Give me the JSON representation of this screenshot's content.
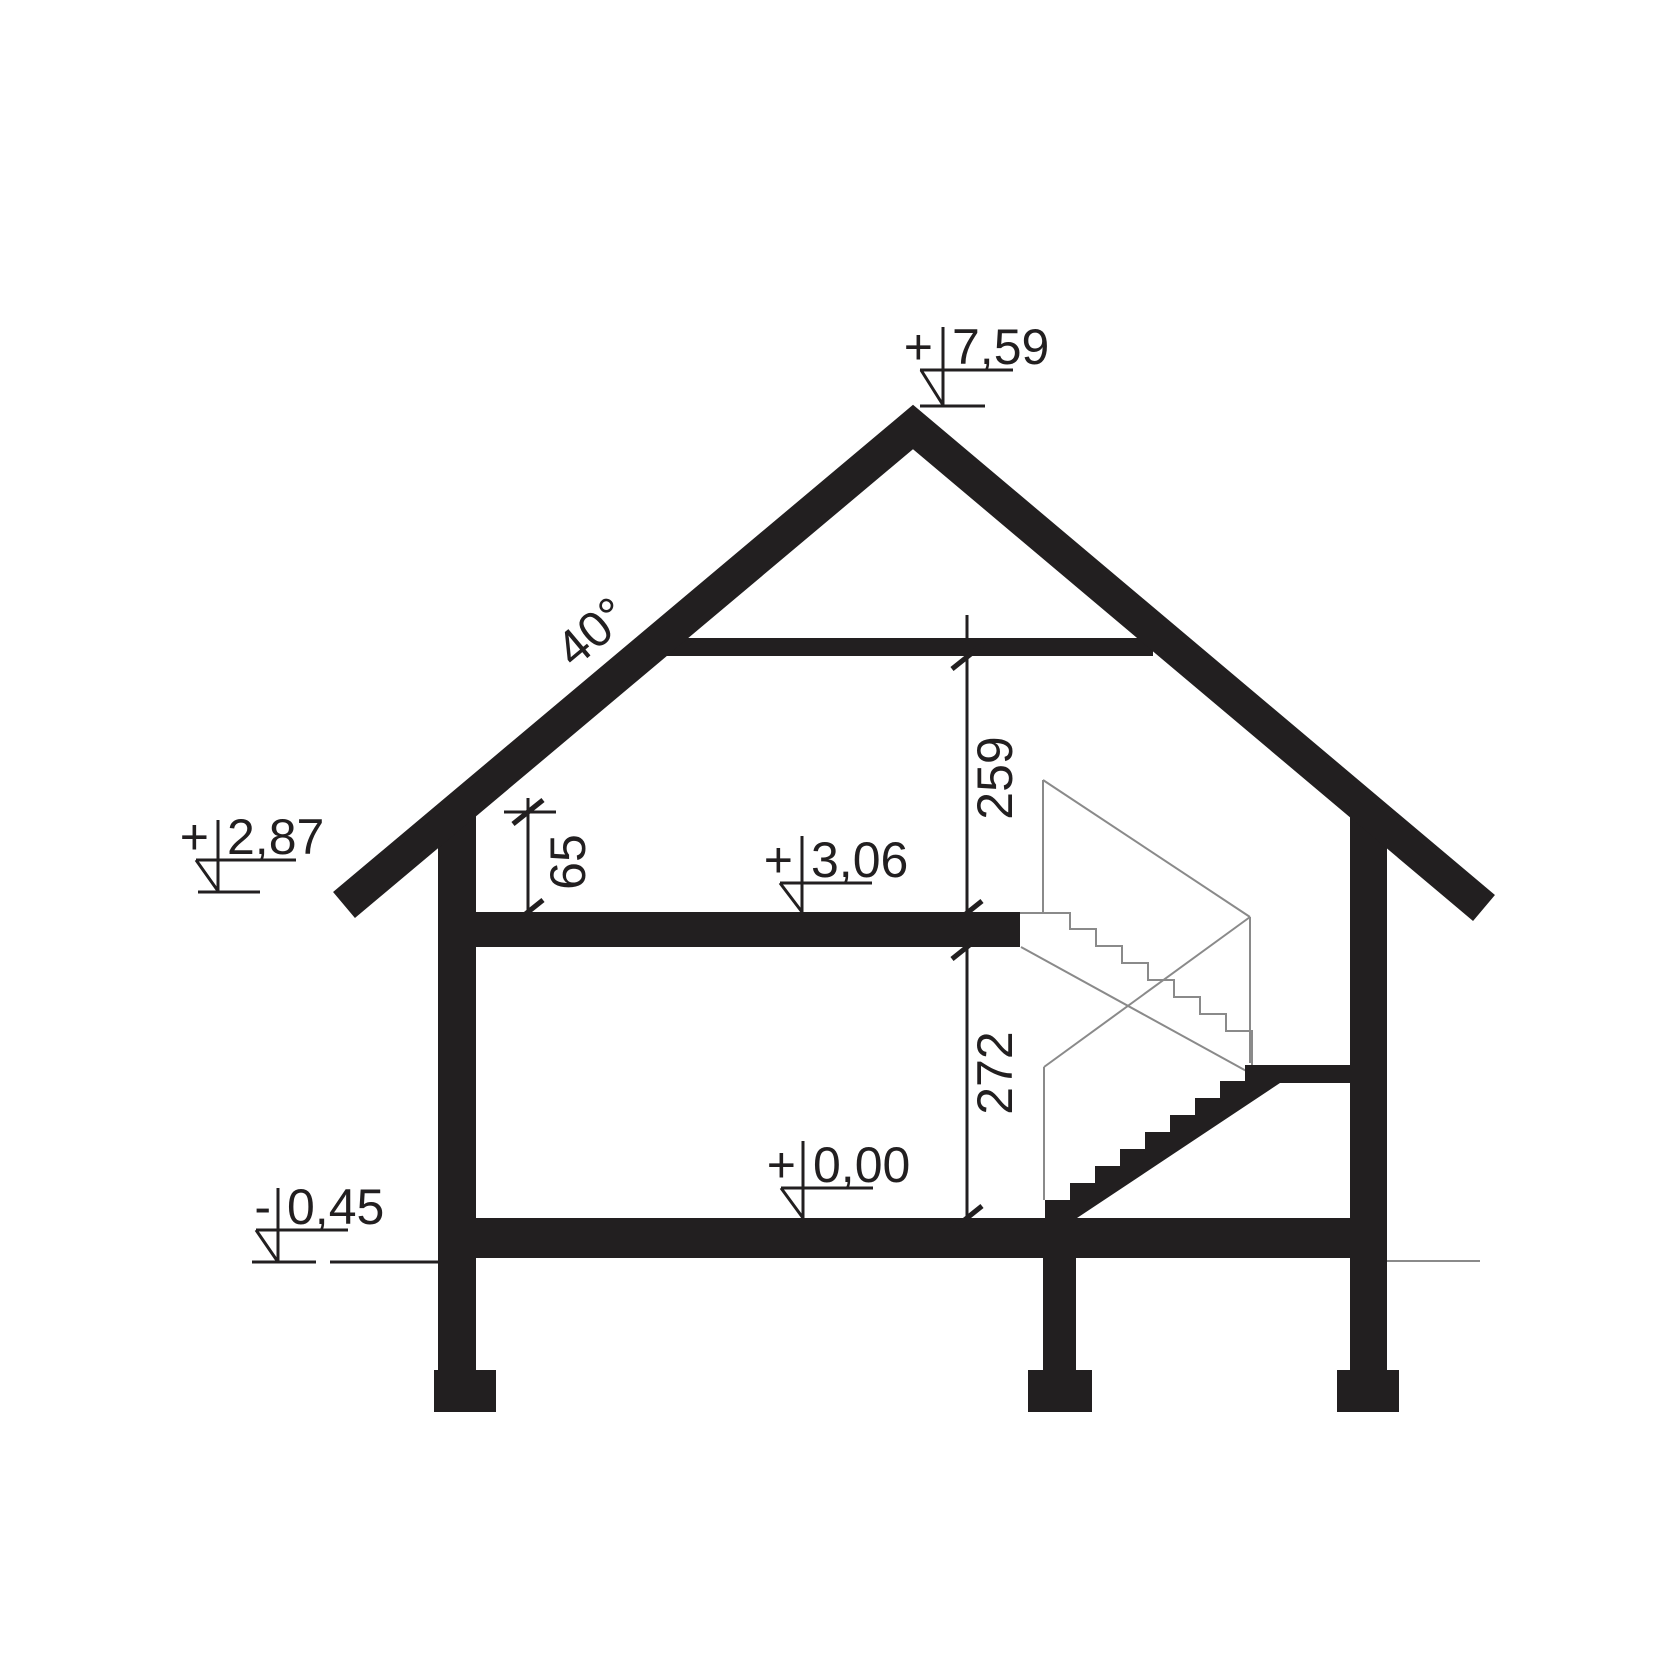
{
  "drawing": {
    "kind": "house-cross-section",
    "colors": {
      "ink": "#221f20",
      "outline_gray": "#8a8a8a",
      "background": "#ffffff"
    },
    "roof_angle": {
      "display": "40°"
    },
    "elevation_marks": [
      {
        "id": "ridge",
        "sign": "+",
        "value": "7,59"
      },
      {
        "id": "left-eave",
        "sign": "+",
        "value": "2,87"
      },
      {
        "id": "attic-floor",
        "sign": "+",
        "value": "3,06"
      },
      {
        "id": "ground-floor",
        "sign": "+",
        "value": "0,00"
      },
      {
        "id": "terrain",
        "sign": "-",
        "value": "0,45"
      }
    ],
    "dimensions": [
      {
        "id": "knee-wall-height",
        "value": "65"
      },
      {
        "id": "attic-room-height",
        "value": "259"
      },
      {
        "id": "ground-floor-height",
        "value": "272"
      }
    ]
  }
}
